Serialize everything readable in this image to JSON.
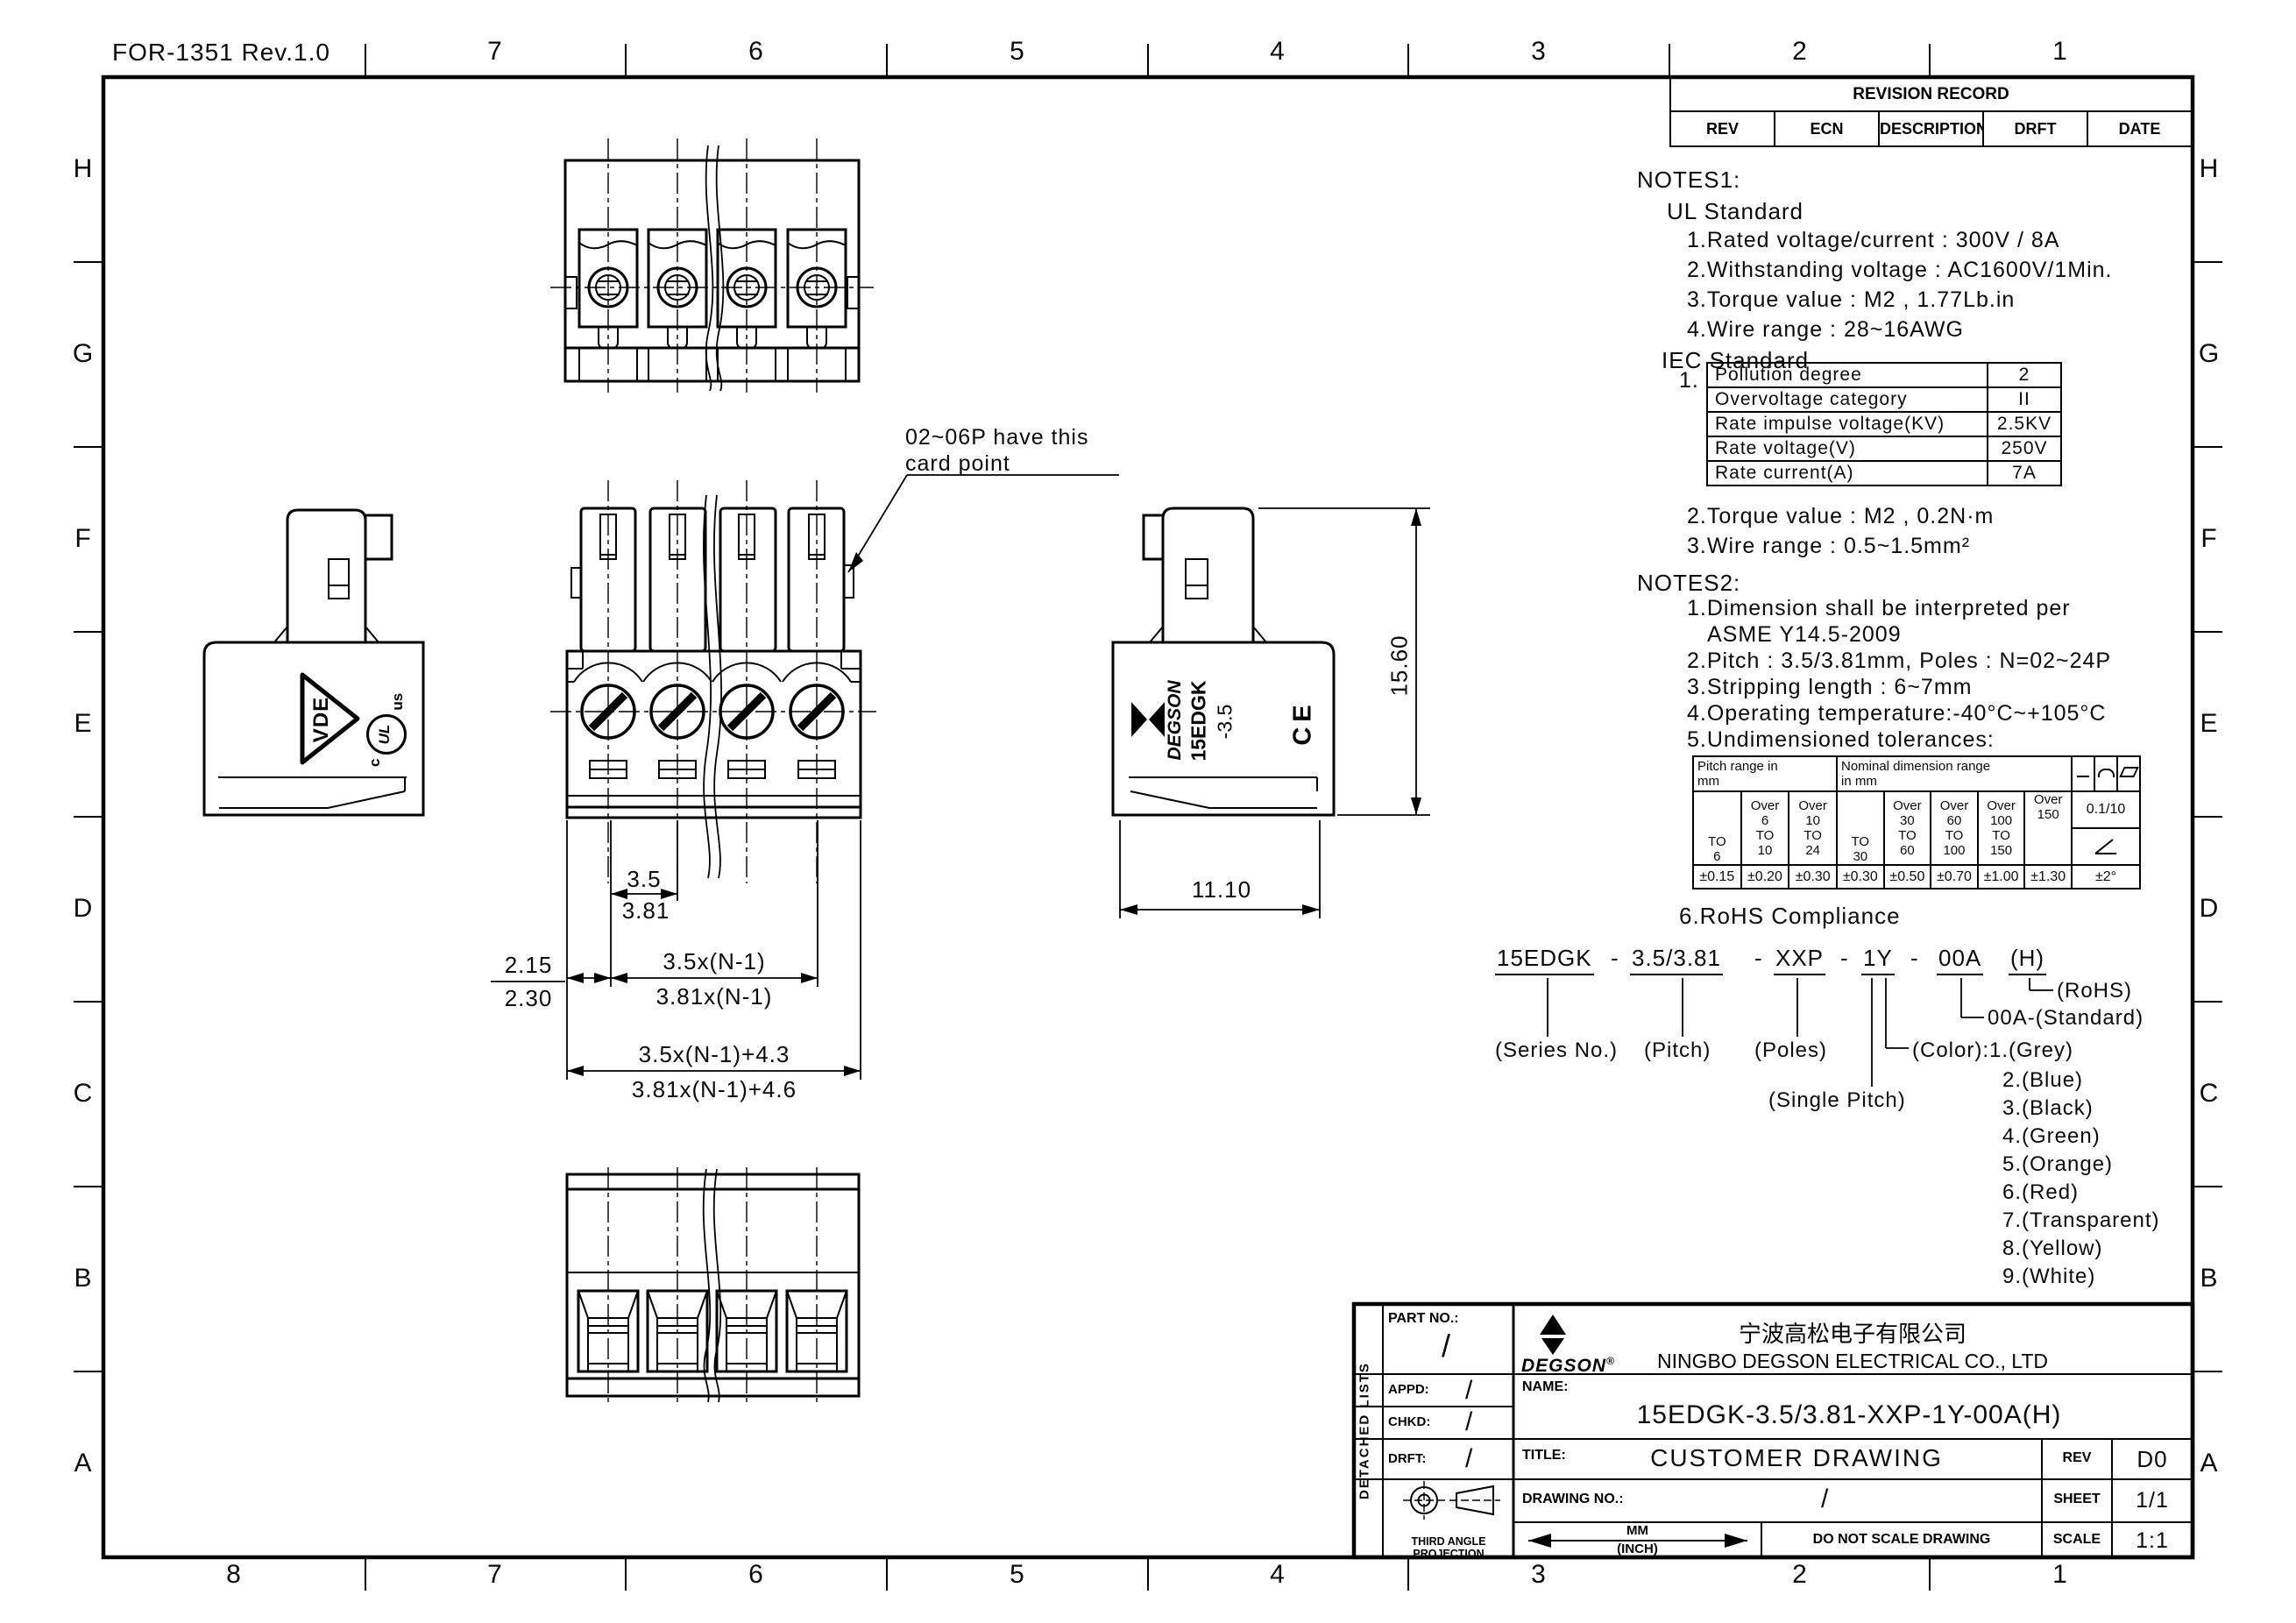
{
  "sheet": {
    "form_ref": "FOR-1351 Rev.1.0",
    "top_cols": [
      "7",
      "6",
      "5",
      "4",
      "3",
      "2",
      "1"
    ],
    "bottom_cols": [
      "8",
      "7",
      "6",
      "5",
      "4",
      "3",
      "2",
      "1"
    ],
    "row_labels": [
      "H",
      "G",
      "F",
      "E",
      "D",
      "C",
      "B",
      "A"
    ]
  },
  "revision_record": {
    "title": "REVISION RECORD",
    "columns": [
      "REV",
      "ECN",
      "DESCRIPTION",
      "DRFT",
      "DATE"
    ]
  },
  "notes1": {
    "title": "NOTES1:",
    "ul_title": "UL Standard",
    "ul_items": [
      "1.Rated voltage/current : 300V / 8A",
      "2.Withstanding voltage : AC1600V/1Min.",
      "3.Torque value : M2 , 1.77Lb.in",
      "4.Wire range : 28~16AWG"
    ],
    "iec_title": "IEC Standard",
    "iec_item1": "1.",
    "iec_table": {
      "rows": [
        [
          "Pollution degree",
          "2"
        ],
        [
          "Overvoltage category",
          "II"
        ],
        [
          "Rate impulse voltage(KV)",
          "2.5KV"
        ],
        [
          "Rate voltage(V)",
          "250V"
        ],
        [
          "Rate current(A)",
          "7A"
        ]
      ]
    },
    "iec_items": [
      "2.Torque value : M2 , 0.2N·m",
      "3.Wire range : 0.5~1.5mm²"
    ]
  },
  "notes2": {
    "title": "NOTES2:",
    "items": [
      "1.Dimension shall be interpreted per",
      "ASME Y14.5-2009",
      "2.Pitch : 3.5/3.81mm, Poles : N=02~24P",
      "3.Stripping length : 6~7mm",
      "4.Operating temperature:-40°C~+105°C",
      "5.Undimensioned tolerances:"
    ],
    "rohs_item": "6.RoHS Compliance"
  },
  "tolerance_table": {
    "pitch_header": "Pitch range in\nmm",
    "nominal_header": "Nominal dimension range\nin mm",
    "symbol_names": [
      "straightness",
      "arc-profile",
      "flatness",
      "angularity"
    ],
    "pitch_cols": [
      "TO\n6",
      "Over\n6\nTO\n10",
      "Over\n10\nTO\n24"
    ],
    "nominal_cols": [
      "TO\n30",
      "Over\n30\nTO\n60",
      "Over\n60\nTO\n100",
      "Over\n100\nTO\n150",
      "Over\n150"
    ],
    "ratio": "0.1/10",
    "values": [
      "±0.15",
      "±0.20",
      "±0.30",
      "±0.30",
      "±0.50",
      "±0.70",
      "±1.00",
      "±1.30"
    ],
    "angle_value": "±2°"
  },
  "ordering": {
    "sep": "-",
    "segments": [
      "15EDGK",
      "3.5/3.81",
      "XXP",
      "1Y",
      "00A",
      "(H)"
    ],
    "labels": {
      "series": "(Series No.)",
      "pitch": "(Pitch)",
      "poles": "(Poles)",
      "single_pitch": "(Single Pitch)",
      "color": "(Color):1.(Grey)",
      "standard": "00A-(Standard)",
      "rohs": "(RoHS)"
    },
    "colors": [
      "2.(Blue)",
      "3.(Black)",
      "4.(Green)",
      "5.(Orange)",
      "6.(Red)",
      "7.(Transparent)",
      "8.(Yellow)",
      "9.(White)"
    ]
  },
  "annotation": {
    "line1": "02~06P have this",
    "line2": "card point"
  },
  "dimensions": {
    "pitch_a": "3.5",
    "pitch_b": "3.81",
    "edge_a": "2.15",
    "edge_b": "2.30",
    "span_a": "3.5x(N-1)",
    "span_b": "3.81x(N-1)",
    "total_a": "3.5x(N-1)+4.3",
    "total_b": "3.81x(N-1)+4.6",
    "height": "15.60",
    "depth": "11.10"
  },
  "markings": {
    "degson": "DEGSON",
    "reg": "®",
    "model": "15EDGK",
    "model_pitch": "-3.5",
    "ce": "CE",
    "vde": "VDE",
    "ul_c": "c",
    "ul": "UL",
    "ul_us": "us"
  },
  "title_block": {
    "detached_lists": "DETACHED LISTS",
    "part_no_label": "PART NO.:",
    "appd_label": "APPD:",
    "chkd_label": "CHKD:",
    "drft_label": "DRFT:",
    "slash": "/",
    "company_cn": "宁波高松电子有限公司",
    "company_en": "NINGBO DEGSON ELECTRICAL CO., LTD",
    "name_label": "NAME:",
    "name_value": "15EDGK-3.5/3.81-XXP-1Y-00A(H)",
    "title_label": "TITLE:",
    "title_value": "CUSTOMER DRAWING",
    "rev_label": "REV",
    "rev_value": "D0",
    "drawing_no_label": "DRAWING NO.:",
    "sheet_label": "SHEET",
    "sheet_value": "1/1",
    "scale_label": "SCALE",
    "scale_value": "1:1",
    "units_mm": "MM",
    "units_inch": "(INCH)",
    "do_not_scale": "DO NOT SCALE DRAWING",
    "projection_label": "THIRD ANGLE PROJECTION"
  }
}
